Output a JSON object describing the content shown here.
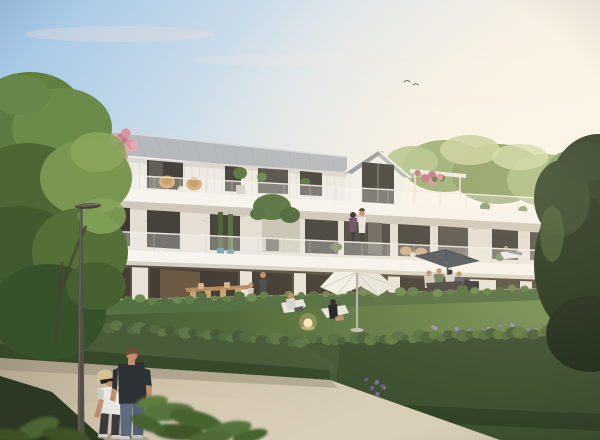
{
  "scene": {
    "kind": "architectural-exterior-rendering",
    "subject": "modern three-storey apartment residence with gabled zinc roof, white brick facades, glass balcony railings, roof terraces and private gardens",
    "lighting": "late-afternoon sun glow from the right",
    "people": [
      "woman-throwing-petanque-ball",
      "man-holding-petanque-ball",
      "couple-standing-on-balcony",
      "man-with-child-on-terrace",
      "man-on-sun-lounger",
      "woman-on-sun-lounger",
      "group-dining-under-grey-parasol",
      "person-resting-on-right-terrace"
    ],
    "objects": [
      "street-lamp",
      "white-butterfly-parasol",
      "grey-parasol",
      "sun-loungers",
      "glowing-garden-lamp",
      "petanque-boule",
      "wooden-dining-table",
      "pink-flowering-potted-tree",
      "orange-lounge-chairs",
      "pergola-with-flowers",
      "boxwood-hedges",
      "lavender-border",
      "gravel-path",
      "large-left-tree",
      "dark-right-tree"
    ],
    "counts": {
      "gables": 2,
      "parasols": 2,
      "foreground_people": 2
    }
  },
  "palette": {
    "sky_top": "#9cc3e6",
    "sky_mid": "#d6e2ea",
    "sky_warm": "#f5eee2",
    "sun_glow": "#fdf7ec",
    "cloud_pink": "#f0ddd6",
    "bird": "#6f6b60",
    "roof_front": "#b5b9bc",
    "roof_side": "#979ca0",
    "roof_ridge": "#d8dadc",
    "bargeboard": "#f1efe9",
    "attic_wall": "#eceae3",
    "siding_line": "#d8d3ca",
    "gable_wall": "#f2f0ea",
    "slab_white": "#f7f4ee",
    "slab_shadow": "#d5cdbf",
    "brick_light": "#e4ded3",
    "brick_shadow": "#b9b1a1",
    "window_dark": "#45423b",
    "window_glass": "#56534c",
    "window_bright": "#c9c4b5",
    "rail_post": "#cfc9bf",
    "ground_base": "#5a5144",
    "ground_opening": "#443d33",
    "interior_warm": "#a98a60",
    "terrace_floor": "#c7bba4",
    "pier_white": "#e9e3d7",
    "hedge_light": "#6f8a50",
    "hedge_mid": "#557042",
    "hedge_dark": "#3b4e2f",
    "hedge_deep": "#293a21",
    "hedge_fg": "#485c39",
    "lawn_light": "#7a9454",
    "lawn_mid": "#5d7740",
    "lawn_dark": "#3c5130",
    "path_light": "#cfc3ac",
    "path_mid": "#b8ac94",
    "path_dark": "#948b77",
    "tree_lit": "#8aa55c",
    "tree_mid": "#5f7a3e",
    "tree_dark": "#3f5429",
    "tree_right": "#2c3b22",
    "tree_right_deep": "#1e2b18",
    "back_trees": "#9db077",
    "back_trees_lit": "#c6d29c",
    "lamp_metal": "#55514a",
    "pole_metal": "#b3afa6",
    "parasol_white": "#f3f0e8",
    "parasol_shade": "#ddd6c7",
    "parasol_grey": "#4f565d",
    "skin": "#c18f6d",
    "hair_blonde": "#d6c196",
    "hair_brown": "#6a4f37",
    "shirt_dark": "#2d3237",
    "tshirt_white": "#e9e7e2",
    "jeans": "#5c6b80",
    "pants_dark": "#393a3e",
    "dress_black": "#202125",
    "lounger_white": "#e8e5dd",
    "wicker": "#c2955d",
    "chair_orange": "#cf964e",
    "wood": "#b68a5d",
    "blossom_pink": "#dc93a0",
    "blossom_deep": "#c4788a",
    "flower_red": "#a23a3c",
    "flower_purple": "#7b6b9d",
    "lavender": "#8a80ae",
    "boule": "#a8adb2",
    "glow": "#ffe2a0",
    "planter": "#39362e"
  }
}
